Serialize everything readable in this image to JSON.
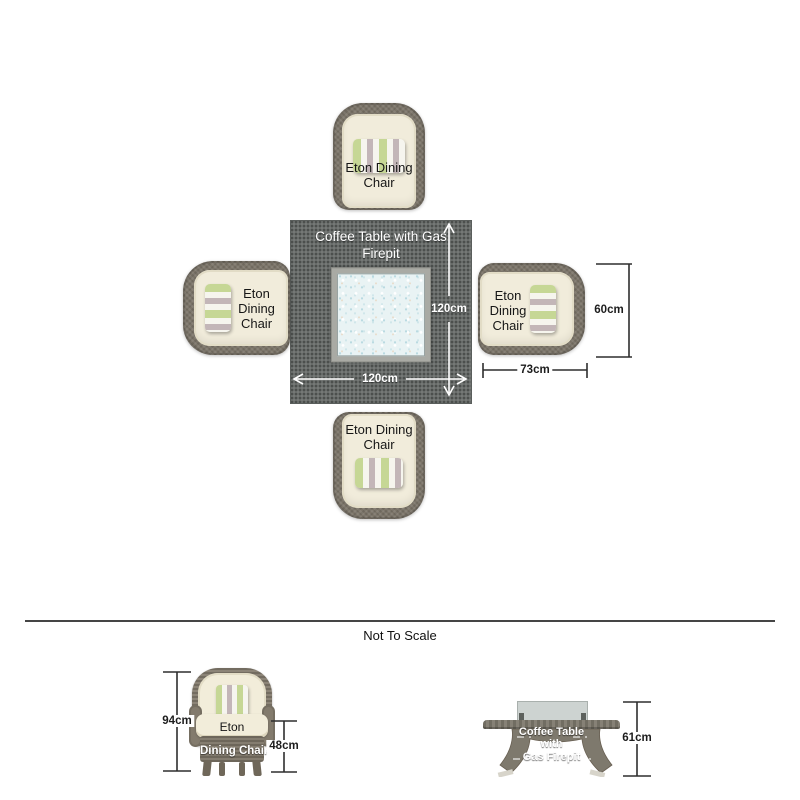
{
  "plan": {
    "table": {
      "label": "Coffee Table with Gas Firepit",
      "width_label": "120cm",
      "depth_label": "120cm"
    },
    "chairs": [
      {
        "position": "top",
        "label": "Eton Dining Chair"
      },
      {
        "position": "left",
        "label": "Eton Dining Chair"
      },
      {
        "position": "right",
        "label": "Eton Dining Chair"
      },
      {
        "position": "bottom",
        "label": "Eton Dining Chair"
      }
    ],
    "chair_dimensions": {
      "width_label": "60cm",
      "depth_label": "73cm"
    }
  },
  "divider": {
    "note": "Not To Scale"
  },
  "elevations": {
    "chair": {
      "label_lines": [
        "Eton",
        "Dining Chair"
      ],
      "height_label": "94cm",
      "seat_height_label": "48cm"
    },
    "table": {
      "label_lines": [
        "Coffee Table",
        "with",
        "Gas Firepit"
      ],
      "height_label": "61cm"
    }
  },
  "colors": {
    "wicker": "#7b7468",
    "table_top": "#686c6a",
    "cushion_cream": "#f1ecdb",
    "stripe_green": "#c6d795",
    "stripe_mauve": "#c3b6b8",
    "firepit_glass": "#e9f3f4",
    "dimension_line": "#2e2e2e"
  }
}
